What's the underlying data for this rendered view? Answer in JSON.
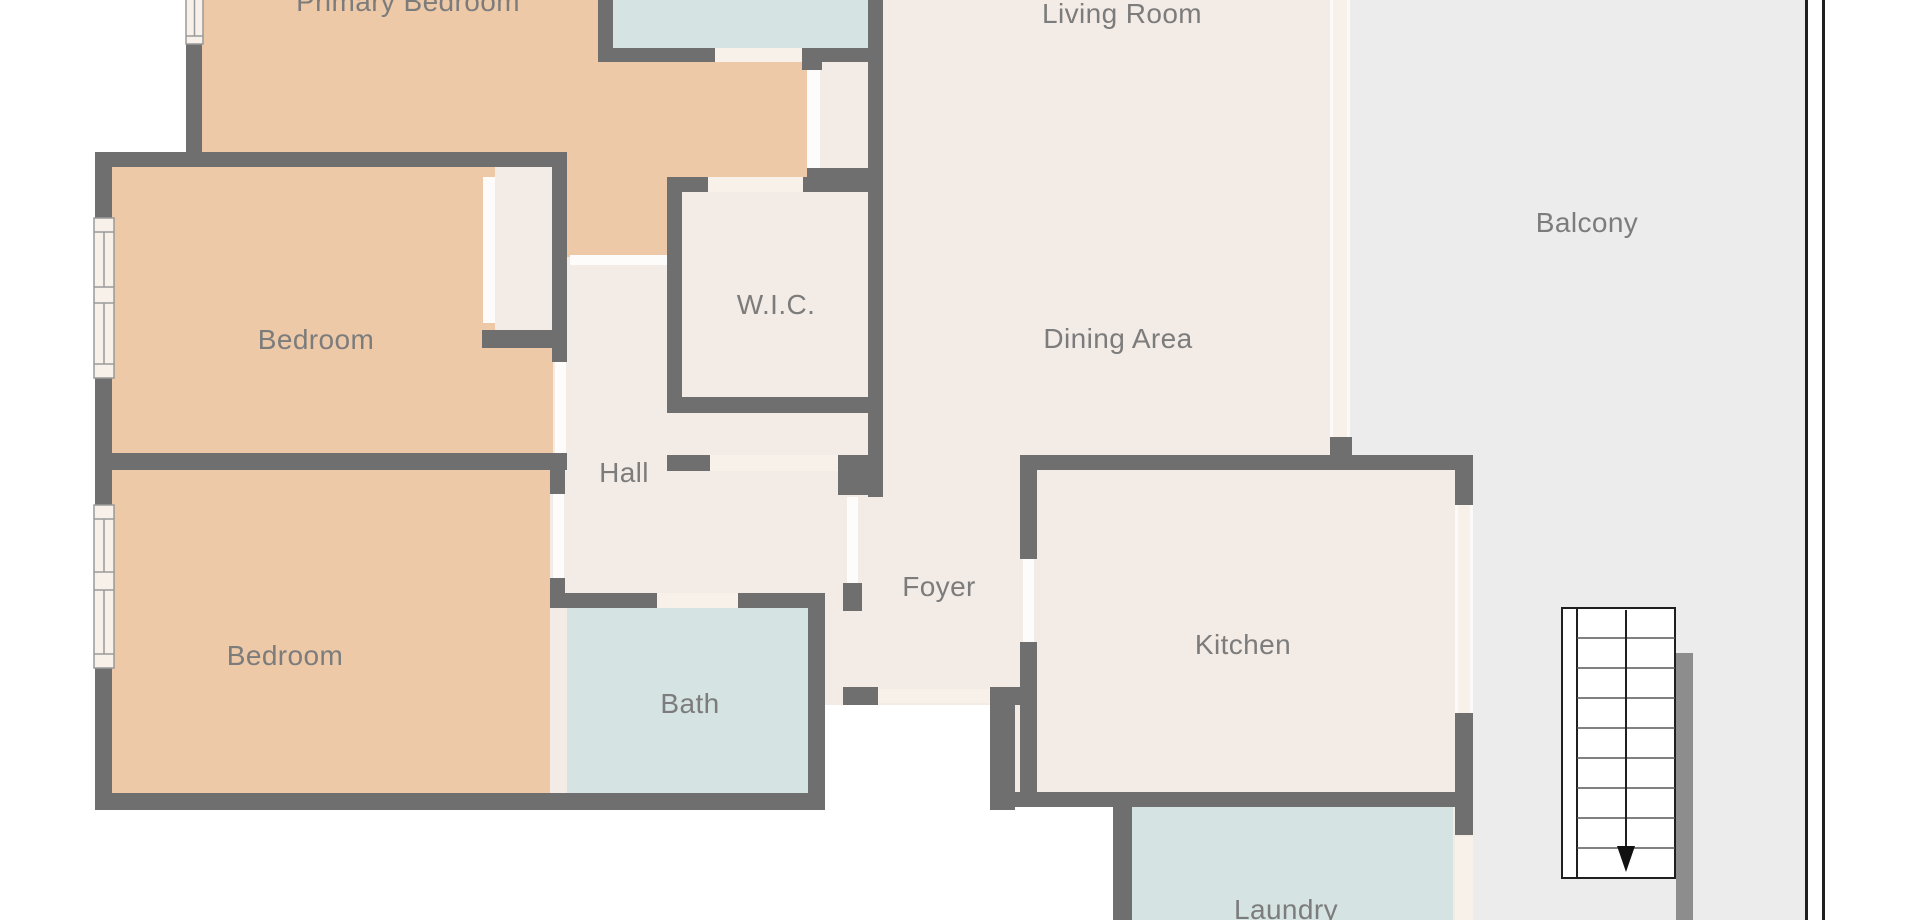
{
  "labels": {
    "primary_bedroom": "Primary Bedroom",
    "living_room": "Living Room",
    "balcony": "Balcony",
    "bedroom_1": "Bedroom",
    "wic": "W.I.C.",
    "dining_area": "Dining Area",
    "hall": "Hall",
    "bedroom_2": "Bedroom",
    "foyer": "Foyer",
    "kitchen": "Kitchen",
    "bath": "Bath",
    "laundry": "Laundry"
  },
  "stairs": {
    "steps": 9,
    "direction": "down"
  },
  "colors": {
    "wall": "#6f6f6f",
    "wall_light": "#8d8d8d",
    "floor": "#f3ebe5",
    "floor_light": "#f7f1ea",
    "bedroom": "#edc9a7",
    "wet": "#d5e3e3",
    "balcony": "#ececec",
    "outside": "#ffffff",
    "label": "#7c7c7c",
    "window_frame": "#9a9a9a",
    "door_leaf": "#fdfcfb",
    "stair_line": "#1f1f1f",
    "railing": "#1f1f1f"
  }
}
